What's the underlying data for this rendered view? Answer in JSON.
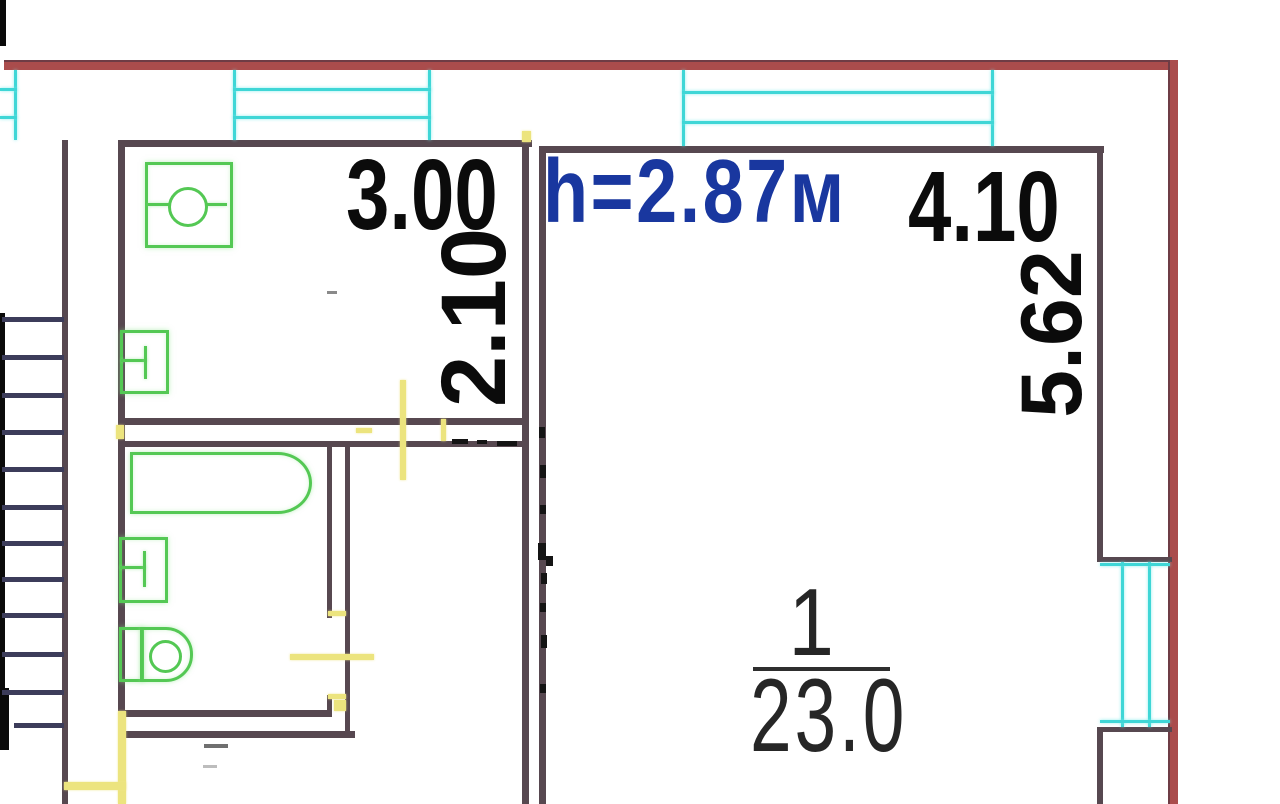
{
  "labels": {
    "kitchen_width": "3.00",
    "kitchen_depth": "2.10",
    "ceiling_height": "h=2.87м",
    "room_width": "4.10",
    "room_depth": "5.62",
    "room_number": "1",
    "room_area": "23.0"
  },
  "colors": {
    "outer_wall_red": "#aa4c4c",
    "inner_wall": "#574850",
    "stair_line": "#3c3c5a",
    "window_cyan": "#3fd6d6",
    "fixture_green": "#54c854",
    "door_yellow": "#ece47e",
    "dimension_text": "#0b0b0b",
    "height_text": "#19379f",
    "room_label_text": "#262626"
  },
  "stairs": {
    "treads": [
      {
        "x": 2,
        "y": 317,
        "w": 62,
        "h": 5
      },
      {
        "x": 2,
        "y": 355,
        "w": 62,
        "h": 5
      },
      {
        "x": 2,
        "y": 393,
        "w": 62,
        "h": 5
      },
      {
        "x": 2,
        "y": 430,
        "w": 62,
        "h": 5
      },
      {
        "x": 2,
        "y": 467,
        "w": 62,
        "h": 5
      },
      {
        "x": 2,
        "y": 505,
        "w": 62,
        "h": 5
      },
      {
        "x": 2,
        "y": 541,
        "w": 62,
        "h": 5
      },
      {
        "x": 2,
        "y": 577,
        "w": 62,
        "h": 5
      },
      {
        "x": 2,
        "y": 613,
        "w": 62,
        "h": 5
      },
      {
        "x": 2,
        "y": 652,
        "w": 62,
        "h": 5
      },
      {
        "x": 2,
        "y": 690,
        "w": 62,
        "h": 5
      },
      {
        "x": 14,
        "y": 723,
        "w": 50,
        "h": 5
      }
    ]
  },
  "doors": {
    "marks": [
      {
        "x": 400,
        "y": 380,
        "w": 6,
        "h": 100
      },
      {
        "x": 356,
        "y": 428,
        "w": 16,
        "h": 5
      },
      {
        "x": 441,
        "y": 419,
        "w": 5,
        "h": 22
      },
      {
        "x": 522,
        "y": 131,
        "w": 9,
        "h": 11
      },
      {
        "x": 116,
        "y": 425,
        "w": 8,
        "h": 14
      },
      {
        "x": 328,
        "y": 611,
        "w": 18,
        "h": 5
      },
      {
        "x": 290,
        "y": 654,
        "w": 84,
        "h": 6
      },
      {
        "x": 328,
        "y": 694,
        "w": 18,
        "h": 5
      },
      {
        "x": 334,
        "y": 700,
        "w": 12,
        "h": 11
      },
      {
        "x": 118,
        "y": 711,
        "w": 8,
        "h": 93
      },
      {
        "x": 64,
        "y": 782,
        "w": 62,
        "h": 8
      }
    ]
  },
  "artifacts": {
    "marks": [
      {
        "x": 452,
        "y": 439,
        "w": 16,
        "h": 5
      },
      {
        "x": 477,
        "y": 440,
        "w": 10,
        "h": 4
      },
      {
        "x": 497,
        "y": 441,
        "w": 20,
        "h": 5
      },
      {
        "x": 539,
        "y": 427,
        "w": 6,
        "h": 11
      },
      {
        "x": 540,
        "y": 465,
        "w": 6,
        "h": 13
      },
      {
        "x": 540,
        "y": 505,
        "w": 6,
        "h": 9
      },
      {
        "x": 538,
        "y": 543,
        "w": 8,
        "h": 17
      },
      {
        "x": 541,
        "y": 573,
        "w": 6,
        "h": 11
      },
      {
        "x": 540,
        "y": 603,
        "w": 6,
        "h": 9
      },
      {
        "x": 541,
        "y": 635,
        "w": 6,
        "h": 13
      },
      {
        "x": 540,
        "y": 684,
        "w": 6,
        "h": 9
      },
      {
        "x": 546,
        "y": 556,
        "w": 7,
        "h": 10
      },
      {
        "x": 204,
        "y": 744,
        "w": 24,
        "h": 4,
        "c": "#6f6f6f"
      },
      {
        "x": 327,
        "y": 291,
        "w": 10,
        "h": 3,
        "c": "#8a8a8a"
      },
      {
        "x": 203,
        "y": 765,
        "w": 14,
        "h": 3,
        "c": "#bdbdbd"
      }
    ]
  }
}
